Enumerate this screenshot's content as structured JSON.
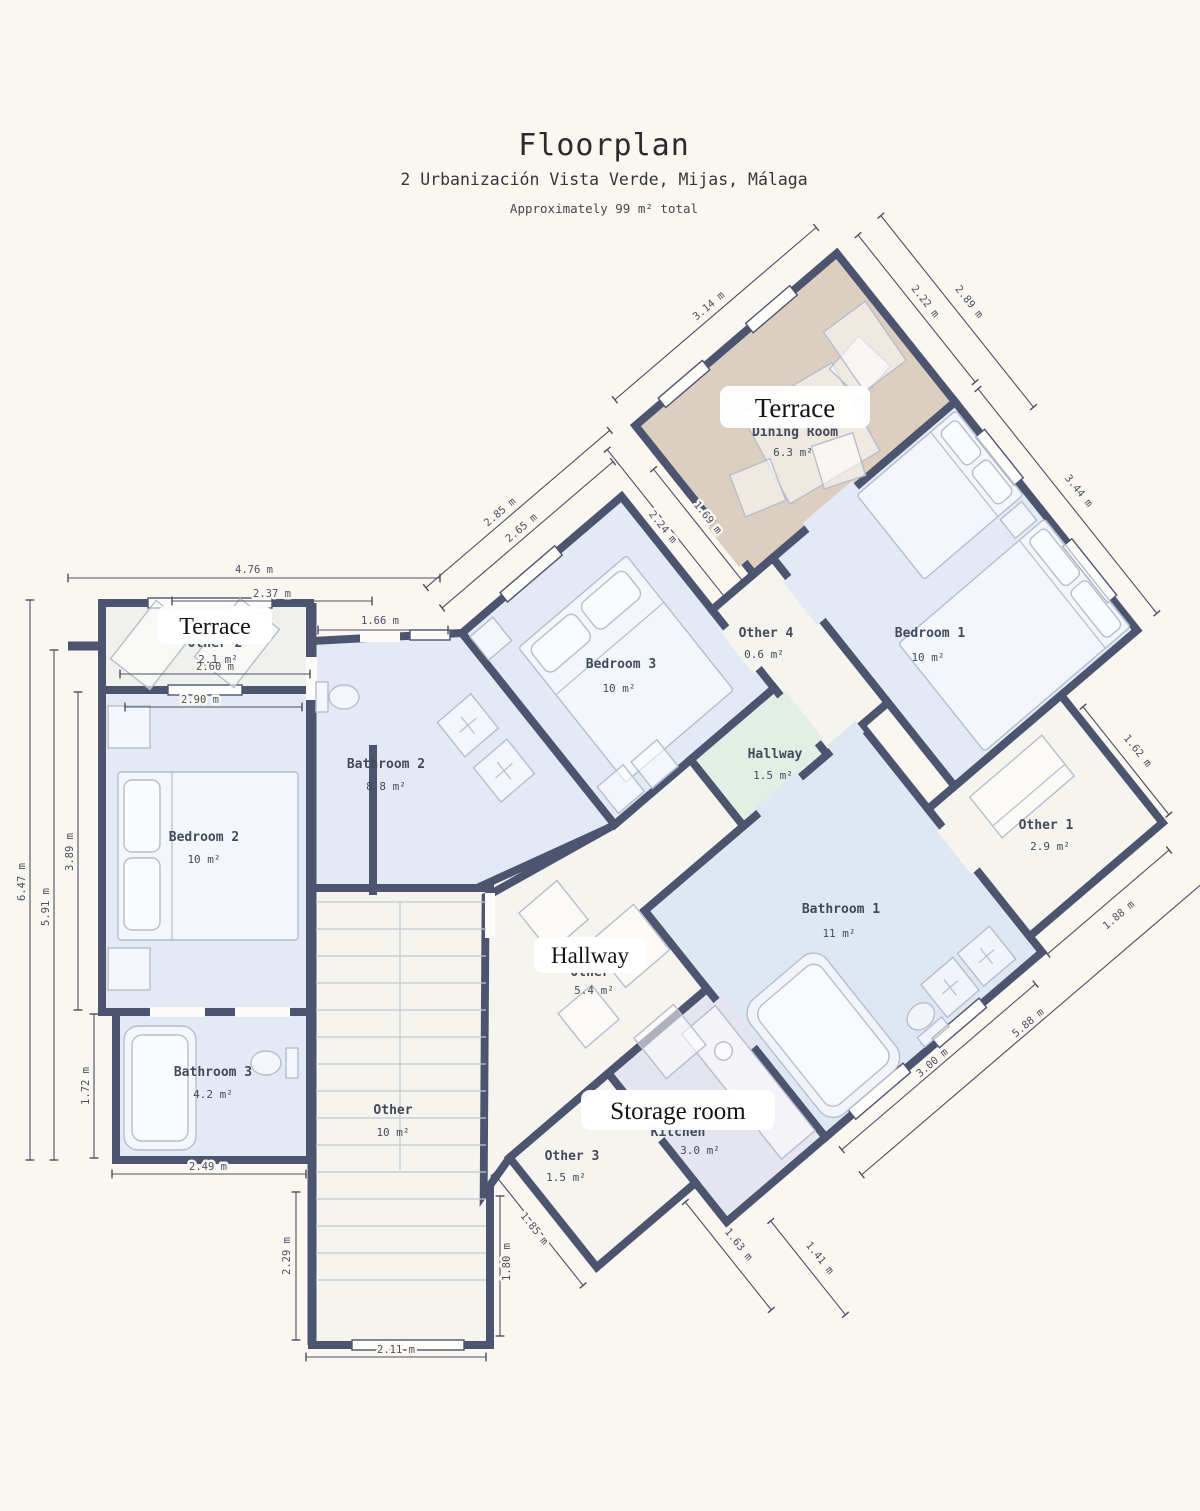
{
  "header": {
    "title": "Floorplan",
    "address": "2 Urbanización Vista Verde, Mijas, Málaga",
    "note": "Approximately 99 m² total"
  },
  "palette": {
    "bg": "#faf7f1",
    "wall": "#4d5470",
    "blue": "#e4eaf5",
    "blue_deep": "#dfe7f3",
    "tan": "#dccfbf",
    "green": "#e3efe5",
    "cream": "#f5f4ee",
    "lavender": "#e5e5f0",
    "terrace_left": "#f0f1ec",
    "label": "#434a5c",
    "dimline": "#4a5064",
    "furniture": "#b6bdcc"
  },
  "overlays": {
    "terrace_top": "Terrace",
    "terrace_left": "Terrace",
    "hallway": "Hallway",
    "storage": "Storage room"
  },
  "rooms": {
    "dining": {
      "name": "Dining Room",
      "area": "6.3 m²"
    },
    "bedroom1": {
      "name": "Bedroom 1",
      "area": "10 m²"
    },
    "bedroom2": {
      "name": "Bedroom 2",
      "area": "10 m²"
    },
    "bedroom3": {
      "name": "Bedroom 3",
      "area": "10 m²"
    },
    "bathroom1": {
      "name": "Bathroom 1",
      "area": "11 m²"
    },
    "bathroom2": {
      "name": "Bathroom 2",
      "area": "8.8 m²"
    },
    "bathroom3": {
      "name": "Bathroom 3",
      "area": "4.2 m²"
    },
    "hallway_small": {
      "name": "Hallway",
      "area": "1.5 m²"
    },
    "hallway_main": {
      "name": "Other",
      "area": "5.4 m²"
    },
    "kitchen": {
      "name": "Kitchen",
      "area": "3.0 m²"
    },
    "stairs": {
      "name": "Other",
      "area": "10 m²"
    },
    "other1": {
      "name": "Other 1",
      "area": "2.9 m²"
    },
    "other2": {
      "name": "Other 2",
      "area": "2.1 m²"
    },
    "other3": {
      "name": "Other 3",
      "area": "1.5 m²"
    },
    "other4": {
      "name": "Other 4",
      "area": "0.6 m²"
    }
  },
  "dims": {
    "d476": "4.76 m",
    "d237": "2.37 m",
    "d260": "2.60 m",
    "d290": "2.90 m",
    "d166": "1.66 m",
    "d647": "6.47 m",
    "d591": "5.91 m",
    "d389": "3.89 m",
    "d172": "1.72 m",
    "d249": "2.49 m",
    "d229": "2.29 m",
    "d211": "2.11 m",
    "d180": "1.80 m",
    "d314": "3.14 m",
    "d222": "2.22 m",
    "d289": "2.89 m",
    "d224": "2.24 m",
    "d169": "1.69 m",
    "d285": "2.85 m",
    "d265": "2.65 m",
    "d344": "3.44 m",
    "d162": "1.62 m",
    "d188": "1.88 m",
    "d588": "5.88 m",
    "d300": "3.00 m",
    "d185": "1.85 m",
    "d163": "1.63 m",
    "d141": "1.41 m"
  }
}
